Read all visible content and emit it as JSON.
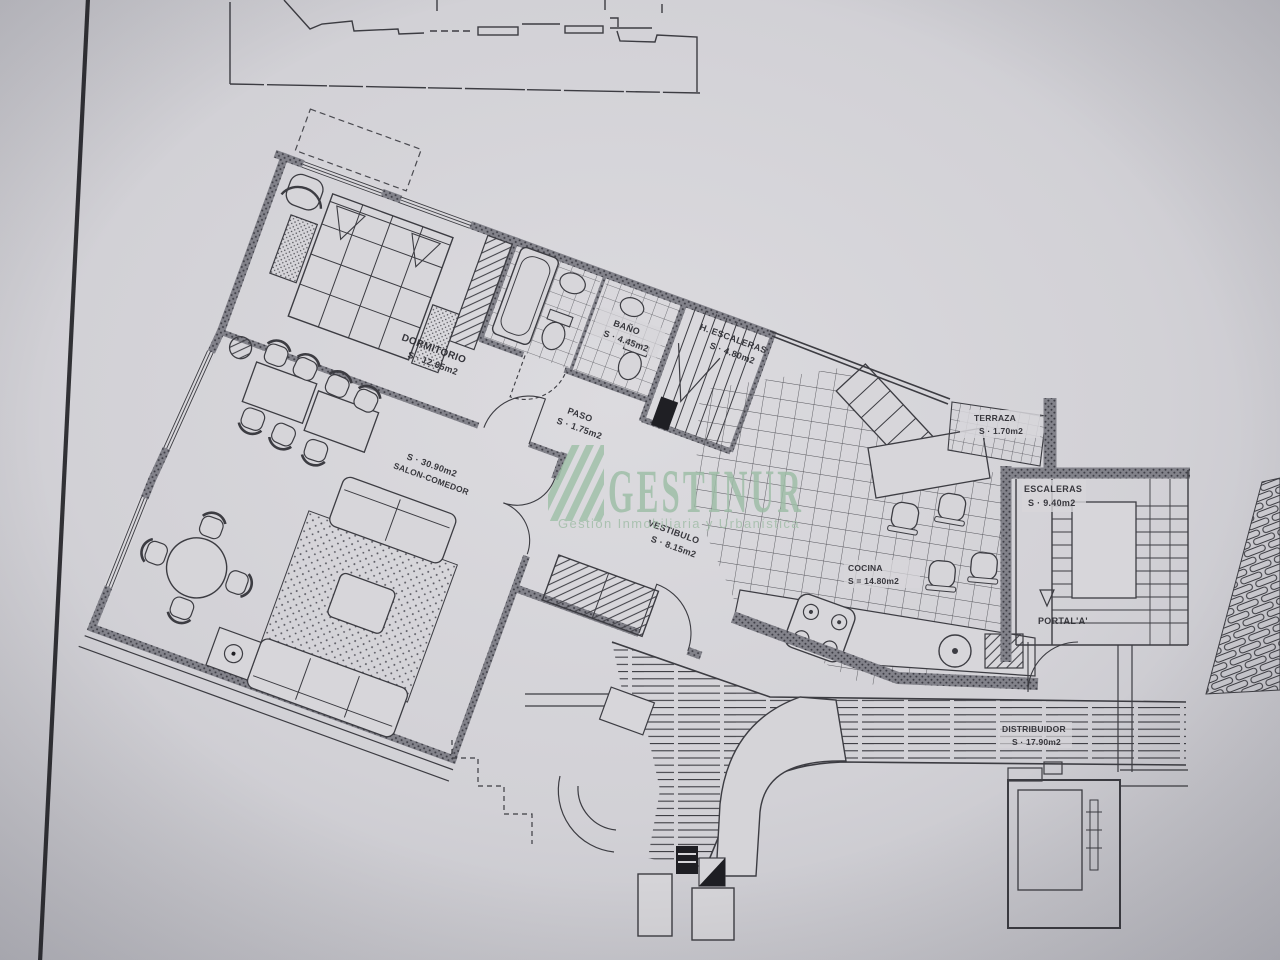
{
  "watermark": {
    "brand": "GESTINUR",
    "tagline": "Gestión Inmobiliaria y Urbanística"
  },
  "rooms": {
    "dormitorio": {
      "name": "DORMITORIO",
      "area": "S · 12.85m2"
    },
    "bano": {
      "name": "BAÑO",
      "area": "S · 4.45m2"
    },
    "h_escaleras": {
      "name": "H. ESCALERAS",
      "area": "S · 4.80m2"
    },
    "paso": {
      "name": "PASO",
      "area": "S · 1.75m2"
    },
    "salon": {
      "name": "SALON-COMEDOR",
      "area": "S · 30.90m2"
    },
    "vestibulo": {
      "name": "VESTIBULO",
      "area": "S · 8.15m2"
    },
    "cocina": {
      "name": "COCINA",
      "area": "S = 14.80m2"
    },
    "terraza": {
      "name": "TERRAZA",
      "area": "S · 1.70m2"
    },
    "escaleras": {
      "name": "ESCALERAS",
      "area": "S · 9.40m2"
    },
    "portal": {
      "name": "PORTAL'A'"
    },
    "distribuidor": {
      "name": "DISTRIBUIDOR",
      "area": "S · 17.90m2"
    }
  },
  "colors": {
    "watermark_green": "#9dbda6",
    "paper": "#d3d2d6",
    "ink": "#3c3c42"
  }
}
